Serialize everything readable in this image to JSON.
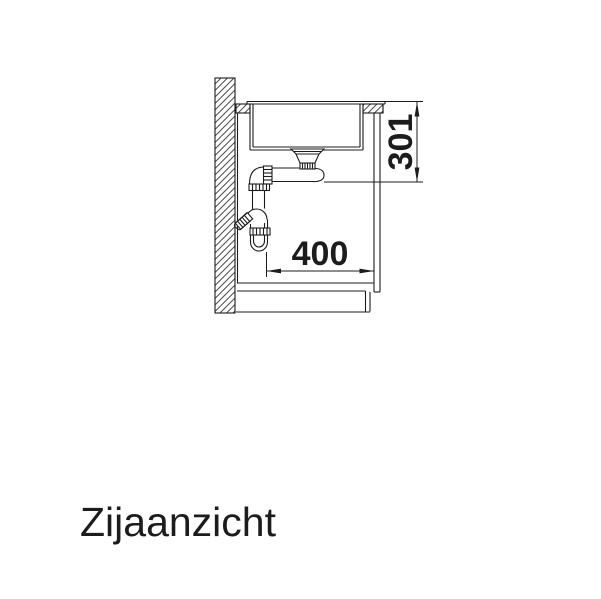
{
  "drawing": {
    "caption": "Zijaanzicht",
    "dim_vertical": "301",
    "dim_horizontal": "400"
  },
  "colors": {
    "line": "#1c1c1c",
    "hatch": "#4d4d4d",
    "background": "#ffffff"
  }
}
